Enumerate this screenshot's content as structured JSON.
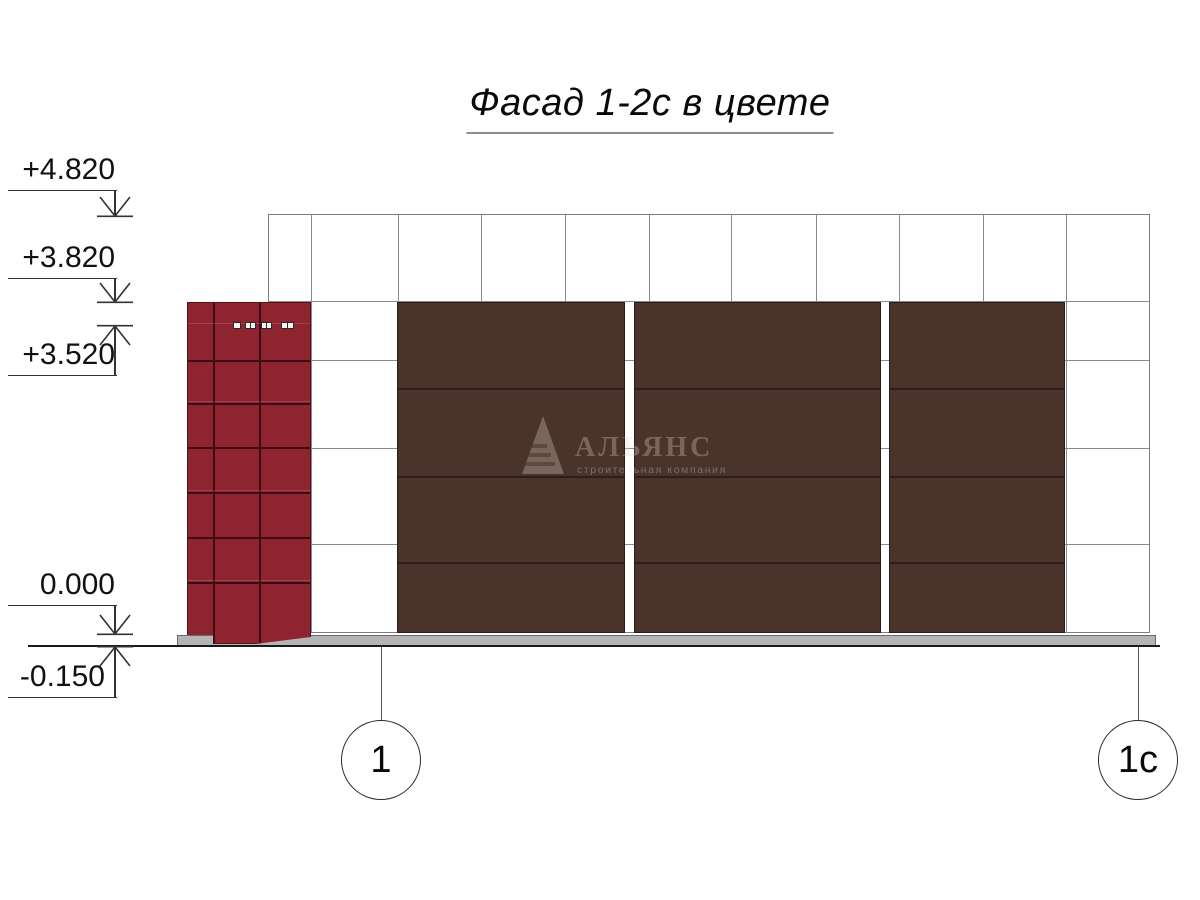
{
  "title": {
    "text": "Фасад 1-2с в цвете"
  },
  "elevation_markers": [
    {
      "label": "+4.820",
      "direction": "down"
    },
    {
      "label": "+3.820",
      "direction": "down"
    },
    {
      "label": "+3.520",
      "direction": "up"
    },
    {
      "label": "0.000",
      "direction": "down"
    },
    {
      "label": "-0.150",
      "direction": "up"
    }
  ],
  "axis_bubbles": [
    {
      "label": "1"
    },
    {
      "label": "1с"
    }
  ],
  "watermark": {
    "company": "АЛЬЯНС",
    "tagline": "строительная компания",
    "logo": "pyramid-logo"
  },
  "colors": {
    "red_tile": "#8e2430",
    "red_joint": "#3c0d14",
    "brown_panel": "#4a332b",
    "brown_joint": "#2c1e18",
    "plinth_gray": "#b5b5b5",
    "grid_line": "#8a8a8a"
  }
}
